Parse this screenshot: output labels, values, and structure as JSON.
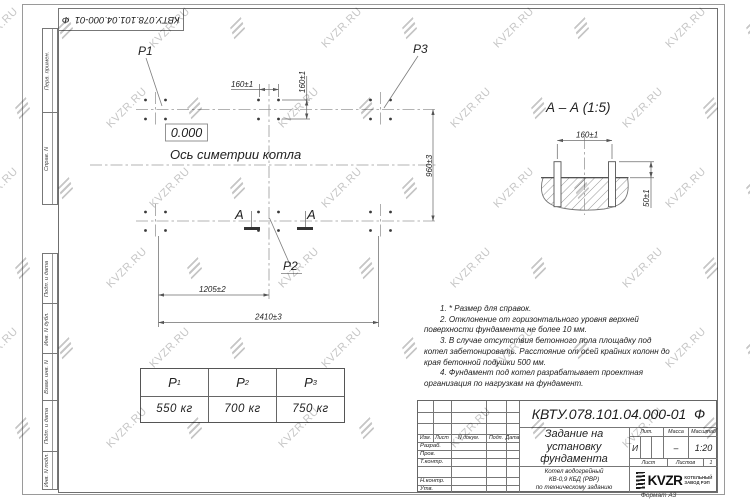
{
  "watermark": {
    "text": "KVZR.RU"
  },
  "corner_stamp": {
    "doc_number": "КВТУ.078.101.04.000-01  Ф"
  },
  "side_labels": {
    "col1": [
      "Перв. примен.",
      "Справ. N"
    ],
    "col2": [
      "Подп. и дата",
      "Инв. N дубл.",
      "Взам. инв. N",
      "Подп. и дата",
      "Инв. N подл."
    ]
  },
  "plan": {
    "level_mark": "0.000",
    "axis_label": "Ось симетрии котла",
    "p1": "P1",
    "p2": "P2",
    "p3": "P3",
    "section_letter": "А",
    "dims": {
      "d160h": "160±1",
      "d160v": "160±1",
      "d960": "960±3",
      "d1205": "1205±2",
      "d2410": "2410±3"
    }
  },
  "section_view": {
    "title": "А  –  А (1:5)",
    "dims": {
      "d160": "160±1",
      "d50": "50±1"
    }
  },
  "notes": [
    "1.  * Размер для справок.",
    "2.  Отклонение от горизонтального уровня верхней поверхности фундамента не более 10 мм.",
    "3.  В случае отсутствия бетонного пола площадку под котел забетонировать. Расстояние от осей крайних колонн до края бетонной подушки 500 мм.",
    "4.  Фундамент под котел разрабатывает проектная организация по нагрузкам на фундамент."
  ],
  "load_table": {
    "columns": [
      {
        "name": "P",
        "sub": "1",
        "value": "550 кг"
      },
      {
        "name": "P",
        "sub": "2",
        "value": "700 кг"
      },
      {
        "name": "P",
        "sub": "3",
        "value": "750 кг"
      }
    ]
  },
  "title_block": {
    "doc_number": "КВТУ.078.101.04.000-01  Ф",
    "title_lines": [
      "Задание на",
      "установку",
      "фундамента"
    ],
    "product_lines": [
      "Котел водогрейный",
      "КВ-0,9 КБД (РВР)",
      "по техническому заданию"
    ],
    "rev_header": [
      "Изм.",
      "Лист",
      "N докум.",
      "Подп.",
      "Дата"
    ],
    "row_labels": [
      "Разраб.",
      "Пров.",
      "Т.контр.",
      "",
      "Н.контр.",
      "Утв."
    ],
    "lit_label": "Лит.",
    "lit_value": "И",
    "mass_label": "Масса",
    "mass_value": "–",
    "scale_label": "Масштаб",
    "scale_value": "1:20",
    "sheet_label": "Лист",
    "sheets_label": "Листов",
    "sheets_value": "1",
    "company": {
      "name": "KVZR",
      "line1": "КОТЕЛЬНЫЙ",
      "line2": "ЗАВОД РЭП"
    },
    "format_label": "Формат  А3"
  }
}
